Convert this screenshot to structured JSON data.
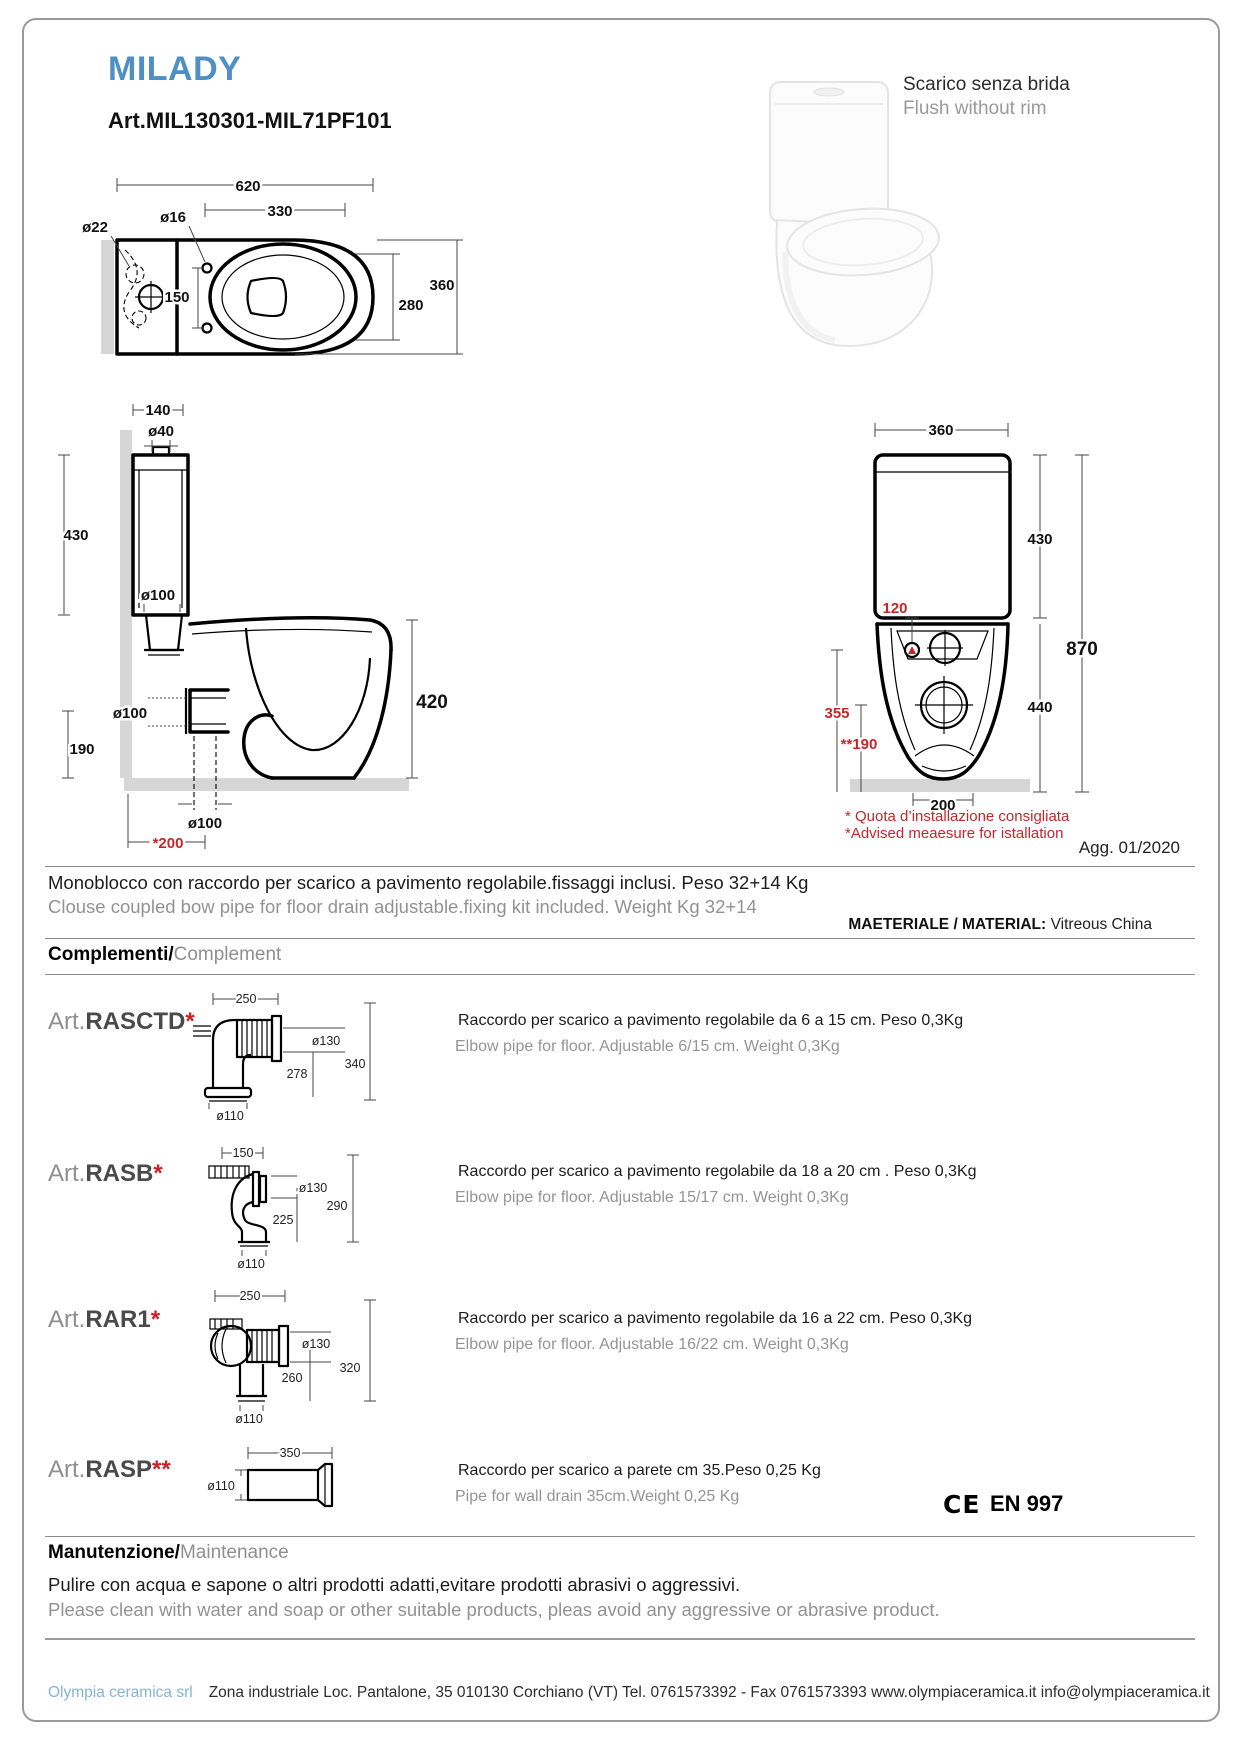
{
  "header": {
    "title": "MILADY",
    "article": "Art.MIL130301-MIL71PF101",
    "flush_note_it": "Scarico senza brida",
    "flush_note_en": "Flush without rim",
    "revision": "Agg. 01/2020"
  },
  "colors": {
    "accent_blue": "#4f90c4",
    "dim_red": "#c4272b",
    "footer_blue": "#85b4d3",
    "gray_text": "#8f8f8f"
  },
  "drawings": {
    "top_view": {
      "width_total": "620",
      "seat_width": "330",
      "hole": "ø16",
      "hole_left": "ø22",
      "hole_spacing": "150",
      "inner_depth": "280",
      "total_depth": "360"
    },
    "side_view": {
      "tank_width": "140",
      "inlet": "ø40",
      "tank_height": "430",
      "outlet_top": "ø100",
      "outlet_rear": "ø100",
      "outlet_height": "190",
      "seat_height": "420",
      "drain": "ø100",
      "drain_distance": "*200"
    },
    "rear_view": {
      "width": "360",
      "tank_height": "430",
      "total_height": "870",
      "bowl_height": "440",
      "hole_offset": "120",
      "fix_height": "355",
      "fix_height2": "**190",
      "base_width": "200",
      "note_it": "* Quota d’installazione consigliata",
      "note_en": "*Advised meaesure for istallation"
    }
  },
  "description": {
    "it": "Monoblocco con raccordo per scarico a pavimento regolabile.fissaggi inclusi. Peso 32+14 Kg",
    "en": "Clouse coupled bow pipe for floor drain adjustable.fixing kit included. Weight Kg 32+14",
    "material_label": "MAETERIALE / MATERIAL:",
    "material_value": "Vitreous China"
  },
  "complements": {
    "heading_it": "Complementi/",
    "heading_en": "Complement",
    "ce_mark": "CE",
    "ce_label": "EN 997",
    "items": [
      {
        "prefix": "Art.",
        "code": "RASCTD",
        "stars": "*",
        "desc_it": "Raccordo per scarico a pavimento regolabile da 6 a 15 cm. Peso 0,3Kg",
        "desc_en": "Elbow pipe for floor. Adjustable 6/15 cm. Weight 0,3Kg",
        "dims": {
          "top": "250",
          "d1": "ø130",
          "h": "340",
          "mid": "278",
          "out": "ø110"
        }
      },
      {
        "prefix": "Art.",
        "code": "RASB",
        "stars": "*",
        "desc_it": "Raccordo per scarico a pavimento regolabile da 18 a 20 cm . Peso 0,3Kg",
        "desc_en": "Elbow pipe for floor. Adjustable 15/17 cm. Weight 0,3Kg",
        "dims": {
          "top": "150",
          "d1": "ø130",
          "h": "290",
          "mid": "225",
          "out": "ø110"
        }
      },
      {
        "prefix": "Art.",
        "code": "RAR1",
        "stars": "*",
        "desc_it": "Raccordo per scarico a pavimento regolabile da 16 a 22 cm. Peso 0,3Kg",
        "desc_en": "Elbow pipe for floor. Adjustable 16/22 cm. Weight 0,3Kg",
        "dims": {
          "top": "250",
          "d1": "ø130",
          "h": "320",
          "mid": "260",
          "out": "ø110"
        }
      },
      {
        "prefix": "Art.",
        "code": "RASP",
        "stars": "**",
        "desc_it": "Raccordo per scarico a parete cm 35.Peso 0,25 Kg",
        "desc_en": "Pipe for wall drain 35cm.Weight 0,25 Kg",
        "dims": {
          "top": "350",
          "out": "ø110"
        }
      }
    ]
  },
  "maintenance": {
    "heading_it": "Manutenzione/",
    "heading_en": "Maintenance",
    "text_it": "Pulire con acqua e sapone o altri prodotti adatti,evitare prodotti abrasivi o aggressivi.",
    "text_en": "Please clean with water and soap or other suitable products, pleas avoid any aggressive or abrasive product."
  },
  "footer": {
    "company": "Olympia ceramica srl",
    "address": "Zona industriale  Loc. Pantalone, 35    010130   Corchiano  (VT)  Tel. 0761573392 - Fax 0761573393    www.olympiaceramica.it    info@olympiaceramica.it"
  }
}
